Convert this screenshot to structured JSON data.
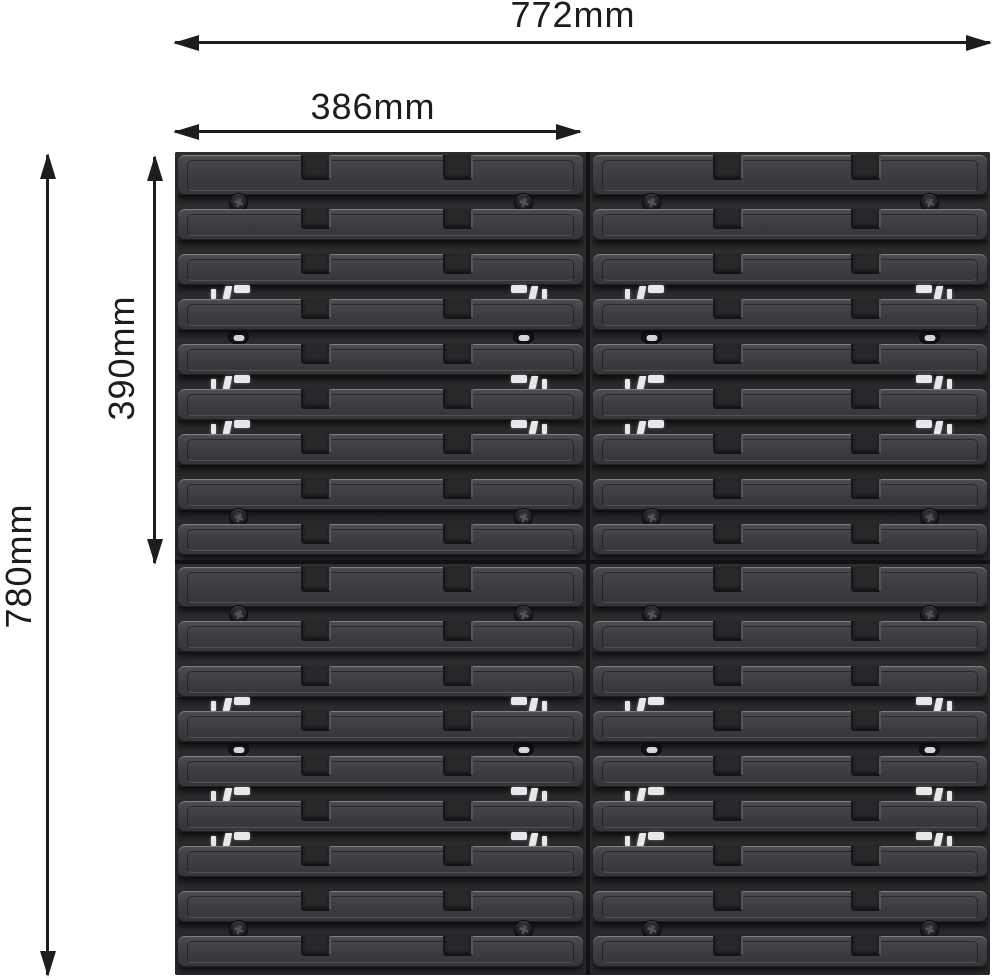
{
  "figure": {
    "kind": "product dimension diagram",
    "subject": "slatted wall mounting panels arranged 2 columns by 2 rows",
    "background": "#ffffff"
  },
  "dimensions": {
    "total_width": "772mm",
    "half_width": "386mm",
    "total_height": "780mm",
    "half_height": "390mm"
  },
  "panel": {
    "grid_rows": 2,
    "grid_cols": 2,
    "slat_rows_per_panel": 9,
    "gap_features": [
      "screws",
      "plain",
      "clips",
      "slots",
      "clips",
      "clips",
      "plain",
      "screws"
    ],
    "colors": {
      "dimension_ink": "#1d1d1f",
      "panel_base": "#29292c",
      "slat_face": "#3e3e42",
      "slat_highlight": "#5a5a5f",
      "seam": "#121214",
      "clip_white": "#e8e8ea",
      "screw_dark": "#0a0a0c",
      "slot_center": "#d6d6d8"
    }
  }
}
